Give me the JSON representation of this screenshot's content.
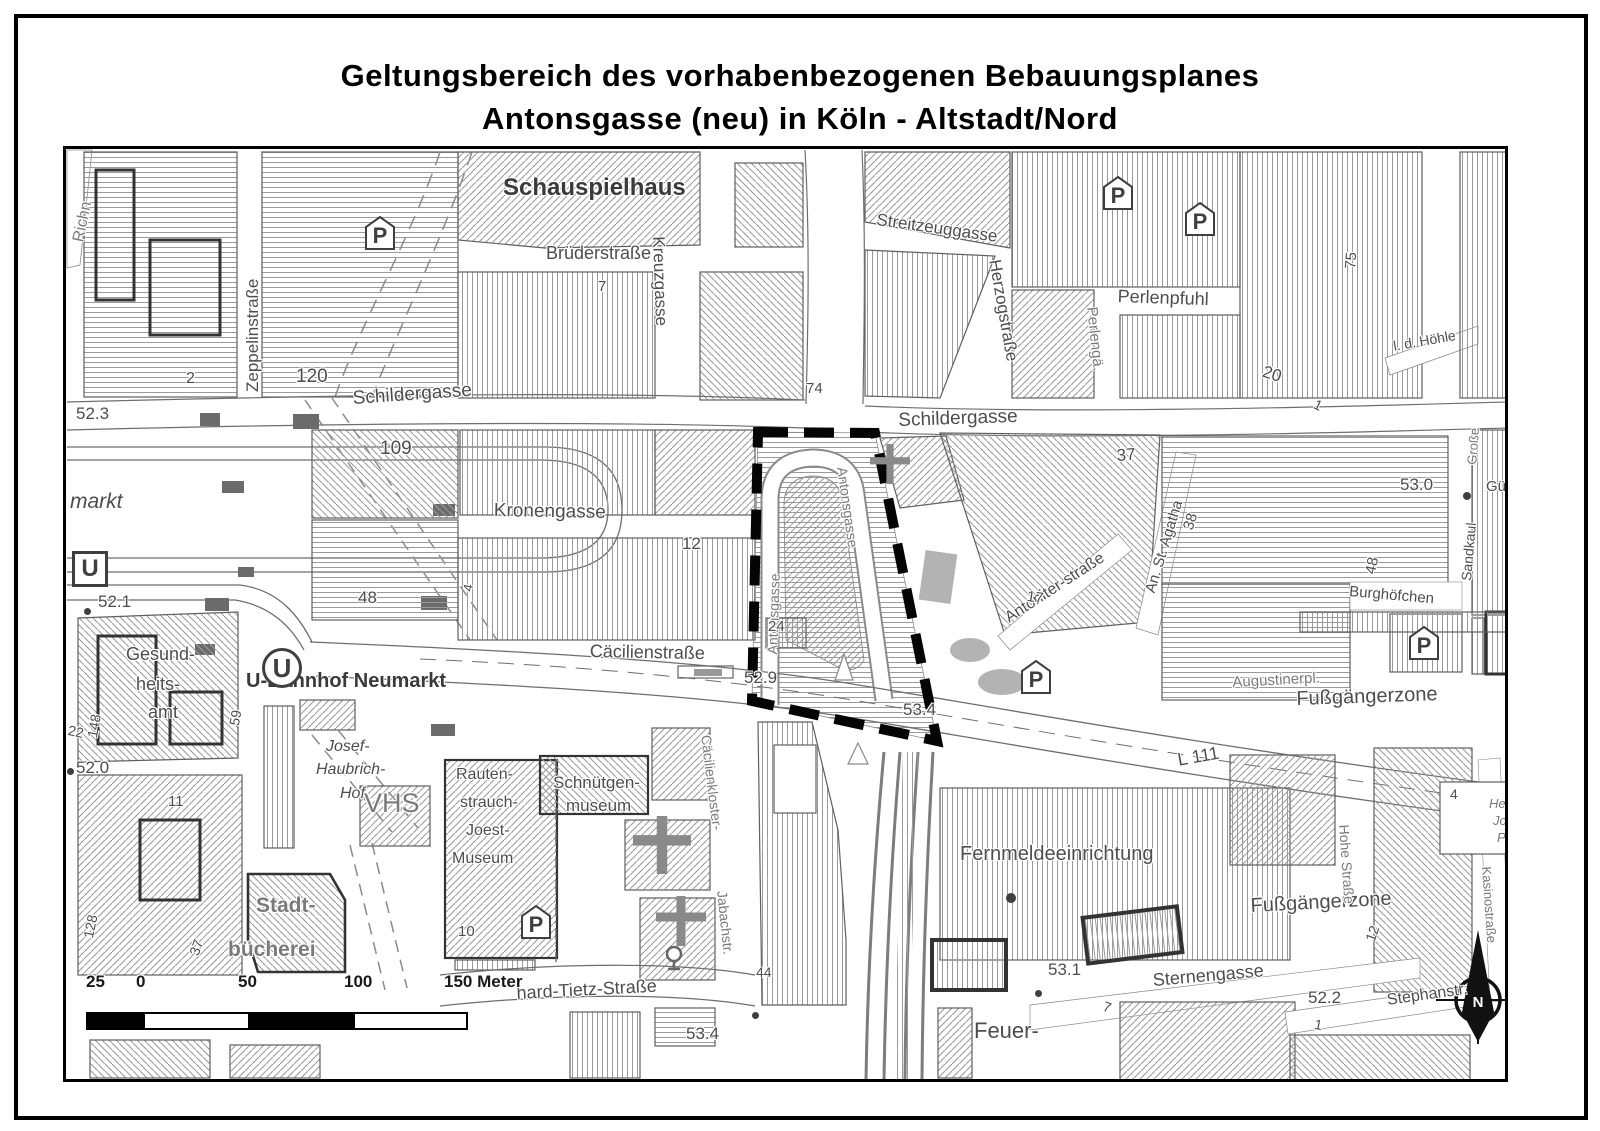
{
  "title": {
    "line1": "Geltungsbereich des vorhabenbezogenen Bebauungsplanes",
    "line2": "Antonsgasse (neu) in Köln - Altstadt/Nord"
  },
  "colors": {
    "ink": "#4d4d4d",
    "hatch": "#9a9a9a",
    "boundary": "#000000"
  },
  "scalebar": {
    "labels": [
      "25",
      "0",
      "50",
      "100",
      "150 Meter"
    ]
  },
  "map": {
    "p_label": "P",
    "u_label": "U",
    "north_label": "N",
    "labels": [
      {
        "n": "street-label-richn",
        "t": "Richn",
        "x": 70,
        "y": 240,
        "r": -78,
        "s": 16,
        "g": 1
      },
      {
        "n": "street-label-zeppelinstrasse",
        "t": "Zeppelinstraße",
        "x": 243,
        "y": 392,
        "r": -90,
        "s": 17
      },
      {
        "n": "house-number",
        "t": "2",
        "x": 186,
        "y": 370,
        "s": 16
      },
      {
        "n": "house-number",
        "t": "120",
        "x": 296,
        "y": 366,
        "s": 19
      },
      {
        "n": "poi-label-schauspielhaus",
        "t": "Schauspielhaus",
        "x": 503,
        "y": 174,
        "s": 24,
        "b": 1
      },
      {
        "n": "street-label-bruederstrasse",
        "t": "Brüderstraße",
        "x": 546,
        "y": 243,
        "s": 18
      },
      {
        "n": "house-number",
        "t": "7",
        "x": 598,
        "y": 278,
        "s": 15
      },
      {
        "n": "street-label-kreuzgasse",
        "t": "Kreuzgasse",
        "x": 668,
        "y": 236,
        "r": 88,
        "s": 17
      },
      {
        "n": "street-label-streitzeuggasse",
        "t": "Streitzeuggasse",
        "x": 878,
        "y": 210,
        "r": 8,
        "s": 17
      },
      {
        "n": "street-label-herzogstrasse",
        "t": "Herzogstraße",
        "x": 1004,
        "y": 258,
        "r": 80,
        "s": 17
      },
      {
        "n": "street-label-perlenpfuhl",
        "t": "Perlenpfuhl",
        "x": 1118,
        "y": 286,
        "r": 2,
        "s": 18
      },
      {
        "n": "street-label-perlengaesschen",
        "t": "Perlengä.",
        "x": 1100,
        "y": 306,
        "r": 84,
        "s": 15,
        "g": 1
      },
      {
        "n": "street-label-schildergasse-west",
        "t": "Schildergasse",
        "x": 352,
        "y": 388,
        "r": -4,
        "s": 19
      },
      {
        "n": "street-label-schildergasse-east",
        "t": "Schildergasse",
        "x": 898,
        "y": 410,
        "r": -2,
        "s": 19
      },
      {
        "n": "house-number",
        "t": "74",
        "x": 806,
        "y": 380,
        "s": 15
      },
      {
        "n": "house-number",
        "t": "109",
        "x": 380,
        "y": 438,
        "s": 19
      },
      {
        "n": "street-label-kronengasse",
        "t": "Kronengasse",
        "x": 494,
        "y": 500,
        "r": 1,
        "s": 19
      },
      {
        "n": "house-number",
        "t": "12",
        "x": 682,
        "y": 534,
        "s": 17
      },
      {
        "n": "house-number",
        "t": "48",
        "x": 358,
        "y": 588,
        "s": 17
      },
      {
        "n": "house-number",
        "t": "4",
        "x": 460,
        "y": 590,
        "r": -80,
        "s": 13
      },
      {
        "n": "place-label-neumarkt",
        "t": "markt",
        "x": 70,
        "y": 490,
        "s": 21,
        "it": 1
      },
      {
        "n": "elevation-label",
        "t": "52.3",
        "x": 76,
        "y": 404,
        "s": 17
      },
      {
        "n": "elevation-label",
        "t": "52.1",
        "x": 98,
        "y": 592,
        "s": 17
      },
      {
        "n": "elevation-label",
        "t": "52.0",
        "x": 76,
        "y": 758,
        "s": 17
      },
      {
        "n": "street-label-antonsgasse-west",
        "t": "Antonsgasse",
        "x": 764,
        "y": 654,
        "r": -88,
        "s": 14,
        "g": 1
      },
      {
        "n": "street-label-antonsgasse-east",
        "t": "Antonsgasse",
        "x": 850,
        "y": 466,
        "r": 82,
        "s": 14,
        "g": 1
      },
      {
        "n": "house-number",
        "t": "24",
        "x": 768,
        "y": 618,
        "s": 15
      },
      {
        "n": "elevation-label",
        "t": "52.9",
        "x": 744,
        "y": 668,
        "s": 17
      },
      {
        "n": "elevation-label",
        "t": "53.4",
        "x": 903,
        "y": 700,
        "s": 17
      },
      {
        "n": "house-number",
        "t": "37",
        "x": 1116,
        "y": 446,
        "r": -4,
        "s": 17
      },
      {
        "n": "street-label-antoniterstrasse",
        "t": "Antoniter-straße",
        "x": 1002,
        "y": 612,
        "r": -33,
        "s": 16
      },
      {
        "n": "house-number",
        "t": "17",
        "x": 1028,
        "y": 588,
        "r": 8,
        "s": 15
      },
      {
        "n": "street-label-an-st-agatha",
        "t": "An. St. Agatha",
        "x": 1142,
        "y": 590,
        "r": -73,
        "s": 15
      },
      {
        "n": "house-number",
        "t": "38",
        "x": 1180,
        "y": 527,
        "r": -73,
        "s": 15
      },
      {
        "n": "elevation-label",
        "t": "53.0",
        "x": 1400,
        "y": 475,
        "s": 17
      },
      {
        "n": "house-number",
        "t": "48",
        "x": 1362,
        "y": 572,
        "r": -78,
        "s": 15
      },
      {
        "n": "street-label-burghoefchen",
        "t": "Burghöfchen",
        "x": 1350,
        "y": 583,
        "r": 5,
        "s": 15
      },
      {
        "n": "street-label-sandkaul",
        "t": "Sandkaul",
        "x": 1458,
        "y": 580,
        "r": -85,
        "s": 14
      },
      {
        "n": "street-label-grosse",
        "t": "Große",
        "x": 1464,
        "y": 464,
        "r": -85,
        "s": 13,
        "g": 1
      },
      {
        "n": "street-label-guerzenichstrasse",
        "t": "Gürz",
        "x": 1486,
        "y": 478,
        "s": 15
      },
      {
        "n": "street-label-in-der-hoehle",
        "t": "l. d. Höhle",
        "x": 1392,
        "y": 338,
        "r": -10,
        "s": 14
      },
      {
        "n": "house-number",
        "t": "20",
        "x": 1266,
        "y": 362,
        "r": 18,
        "s": 17
      },
      {
        "n": "house-number",
        "t": "75",
        "x": 1342,
        "y": 268,
        "r": -85,
        "s": 15
      },
      {
        "n": "house-number",
        "t": "1",
        "x": 1318,
        "y": 396,
        "r": 25,
        "s": 14
      },
      {
        "n": "poi-label-u-bahnhof-neumarkt",
        "t": "U-Bahnhof Neumarkt",
        "x": 246,
        "y": 670,
        "s": 20,
        "b": 1
      },
      {
        "n": "poi-label-gesundheitsamt-1",
        "t": "Gesund-",
        "x": 126,
        "y": 644,
        "s": 18
      },
      {
        "n": "poi-label-gesundheitsamt-2",
        "t": "heits-",
        "x": 136,
        "y": 674,
        "s": 18
      },
      {
        "n": "poi-label-gesundheitsamt-3",
        "t": "amt",
        "x": 148,
        "y": 702,
        "s": 18
      },
      {
        "n": "house-number",
        "t": "148",
        "x": 84,
        "y": 736,
        "r": -80,
        "s": 14
      },
      {
        "n": "house-number",
        "t": "22",
        "x": 70,
        "y": 722,
        "r": 12,
        "s": 14
      },
      {
        "n": "house-number",
        "t": "59",
        "x": 226,
        "y": 724,
        "r": -80,
        "s": 14
      },
      {
        "n": "place-label-josef-haubrich-hof-1",
        "t": "Josef-",
        "x": 326,
        "y": 738,
        "s": 16,
        "it": 1
      },
      {
        "n": "place-label-josef-haubrich-hof-2",
        "t": "Haubrich-",
        "x": 316,
        "y": 761,
        "s": 16,
        "it": 1
      },
      {
        "n": "place-label-josef-haubrich-hof-3",
        "t": "Hof",
        "x": 340,
        "y": 785,
        "s": 16,
        "it": 1
      },
      {
        "n": "poi-label-vhs",
        "t": "VHS",
        "x": 364,
        "y": 788,
        "s": 27,
        "g": 1
      },
      {
        "n": "poi-label-stadtbuecherei-1",
        "t": "Stadt-",
        "x": 256,
        "y": 894,
        "s": 21,
        "b": 1,
        "g": 1
      },
      {
        "n": "poi-label-stadtbuecherei-2",
        "t": "bücherei",
        "x": 228,
        "y": 938,
        "s": 21,
        "b": 1,
        "g": 1
      },
      {
        "n": "poi-label-rjm-1",
        "t": "Rauten-",
        "x": 456,
        "y": 766,
        "s": 16
      },
      {
        "n": "poi-label-rjm-2",
        "t": "strauch-",
        "x": 460,
        "y": 794,
        "s": 16
      },
      {
        "n": "poi-label-rjm-3",
        "t": "Joest-",
        "x": 466,
        "y": 822,
        "s": 16
      },
      {
        "n": "poi-label-rjm-4",
        "t": "Museum",
        "x": 452,
        "y": 850,
        "s": 16
      },
      {
        "n": "house-number",
        "t": "10",
        "x": 458,
        "y": 923,
        "s": 15
      },
      {
        "n": "poi-label-schnuetgenmuseum-1",
        "t": "Schnütgen-",
        "x": 553,
        "y": 773,
        "s": 17
      },
      {
        "n": "poi-label-schnuetgenmuseum-2",
        "t": "museum",
        "x": 566,
        "y": 796,
        "s": 17
      },
      {
        "n": "house-number",
        "t": "11",
        "x": 168,
        "y": 793,
        "s": 15
      },
      {
        "n": "house-number",
        "t": "128",
        "x": 80,
        "y": 936,
        "r": -78,
        "s": 14
      },
      {
        "n": "house-number",
        "t": "37",
        "x": 186,
        "y": 952,
        "r": -70,
        "s": 14
      },
      {
        "n": "street-label-caecilienstrasse",
        "t": "Cäcilienstraße",
        "x": 590,
        "y": 641,
        "r": 1,
        "s": 18
      },
      {
        "n": "street-label-caecilienkloster",
        "t": "Cäcilienkloster-",
        "x": 714,
        "y": 734,
        "r": 83,
        "s": 14,
        "g": 1
      },
      {
        "n": "street-label-jabachstrasse",
        "t": "Jabachstr.",
        "x": 730,
        "y": 890,
        "r": 84,
        "s": 14,
        "g": 1
      },
      {
        "n": "house-number",
        "t": "44",
        "x": 756,
        "y": 964,
        "s": 14
      },
      {
        "n": "street-label-l111",
        "t": "L 111",
        "x": 1176,
        "y": 750,
        "r": -10,
        "s": 18
      },
      {
        "n": "zone-label-fussgaengerzone-east",
        "t": "Fußgängerzone",
        "x": 1296,
        "y": 688,
        "r": -2,
        "s": 20
      },
      {
        "n": "place-label-augustinerplatz",
        "t": "Augustinerpl.",
        "x": 1232,
        "y": 674,
        "r": -3,
        "s": 15,
        "g": 1
      },
      {
        "n": "poi-label-fernmeldeeinrichtung",
        "t": "Fernmeldeeinrichtung",
        "x": 960,
        "y": 843,
        "s": 20
      },
      {
        "n": "zone-label-fussgaengerzone-south",
        "t": "Fußgängerzone",
        "x": 1250,
        "y": 895,
        "r": -3,
        "s": 20
      },
      {
        "n": "street-label-sternengasse",
        "t": "Sternengasse",
        "x": 1152,
        "y": 970,
        "r": -5,
        "s": 18
      },
      {
        "n": "elevation-label",
        "t": "53.1",
        "x": 1048,
        "y": 960,
        "s": 17
      },
      {
        "n": "house-number",
        "t": "7",
        "x": 1106,
        "y": 998,
        "r": 18,
        "s": 14
      },
      {
        "n": "elevation-label",
        "t": "52.2",
        "x": 1308,
        "y": 988,
        "s": 17
      },
      {
        "n": "poi-label-feuerwache",
        "t": "Feuer-",
        "x": 974,
        "y": 1018,
        "s": 22
      },
      {
        "n": "street-label-stephanstrasse",
        "t": "Stephanstr.",
        "x": 1386,
        "y": 992,
        "r": -8,
        "s": 16
      },
      {
        "n": "street-label-hohe-strasse",
        "t": "Hohe Straße",
        "x": 1352,
        "y": 824,
        "r": 86,
        "s": 14,
        "g": 1
      },
      {
        "n": "house-number",
        "t": "12",
        "x": 1362,
        "y": 938,
        "r": -70,
        "s": 14
      },
      {
        "n": "street-label-kasinostrasse",
        "t": "Kasinostraße",
        "x": 1494,
        "y": 866,
        "r": 86,
        "s": 13,
        "g": 1
      },
      {
        "n": "house-number",
        "t": "4",
        "x": 1450,
        "y": 786,
        "s": 14
      },
      {
        "n": "place-label-herm-jos-platz-1",
        "t": "Her",
        "x": 1489,
        "y": 796,
        "s": 13,
        "it": 1,
        "g": 1
      },
      {
        "n": "place-label-herm-jos-platz-2",
        "t": "Jos",
        "x": 1493,
        "y": 813,
        "s": 13,
        "it": 1,
        "g": 1
      },
      {
        "n": "place-label-herm-jos-platz-3",
        "t": "Pl",
        "x": 1497,
        "y": 830,
        "s": 13,
        "it": 1,
        "g": 1
      },
      {
        "n": "house-number",
        "t": "1",
        "x": 1316,
        "y": 1016,
        "r": 10,
        "s": 14
      },
      {
        "n": "street-label-leonhard-tietz-strasse",
        "t": "hard-Tietz-Straße",
        "x": 516,
        "y": 983,
        "r": -3,
        "s": 18
      },
      {
        "n": "elevation-label",
        "t": "53.4",
        "x": 686,
        "y": 1024,
        "s": 17
      }
    ],
    "symbols": [
      {
        "t": "p",
        "x": 365,
        "y": 216
      },
      {
        "t": "p",
        "x": 1103,
        "y": 176
      },
      {
        "t": "p",
        "x": 1185,
        "y": 202
      },
      {
        "t": "p",
        "x": 1021,
        "y": 660
      },
      {
        "t": "p",
        "x": 1409,
        "y": 626
      },
      {
        "t": "p",
        "x": 521,
        "y": 905
      },
      {
        "t": "usq",
        "x": 72,
        "y": 551
      },
      {
        "t": "ucir",
        "x": 262,
        "y": 648
      },
      {
        "t": "cross",
        "x": 870,
        "y": 444,
        "s": 40
      },
      {
        "t": "cross",
        "x": 633,
        "y": 816,
        "s": 58
      },
      {
        "t": "cross",
        "x": 656,
        "y": 896,
        "s": 50
      },
      {
        "t": "dot",
        "x": 84,
        "y": 608,
        "s": 7
      },
      {
        "t": "dot",
        "x": 67,
        "y": 768,
        "s": 7
      },
      {
        "t": "dot",
        "x": 1035,
        "y": 990,
        "s": 7
      },
      {
        "t": "dot",
        "x": 1463,
        "y": 492,
        "s": 8
      },
      {
        "t": "dot",
        "x": 752,
        "y": 1012,
        "s": 7
      },
      {
        "t": "dot",
        "x": 1006,
        "y": 893,
        "s": 10
      },
      {
        "t": "well",
        "x": 664,
        "y": 945
      }
    ]
  }
}
